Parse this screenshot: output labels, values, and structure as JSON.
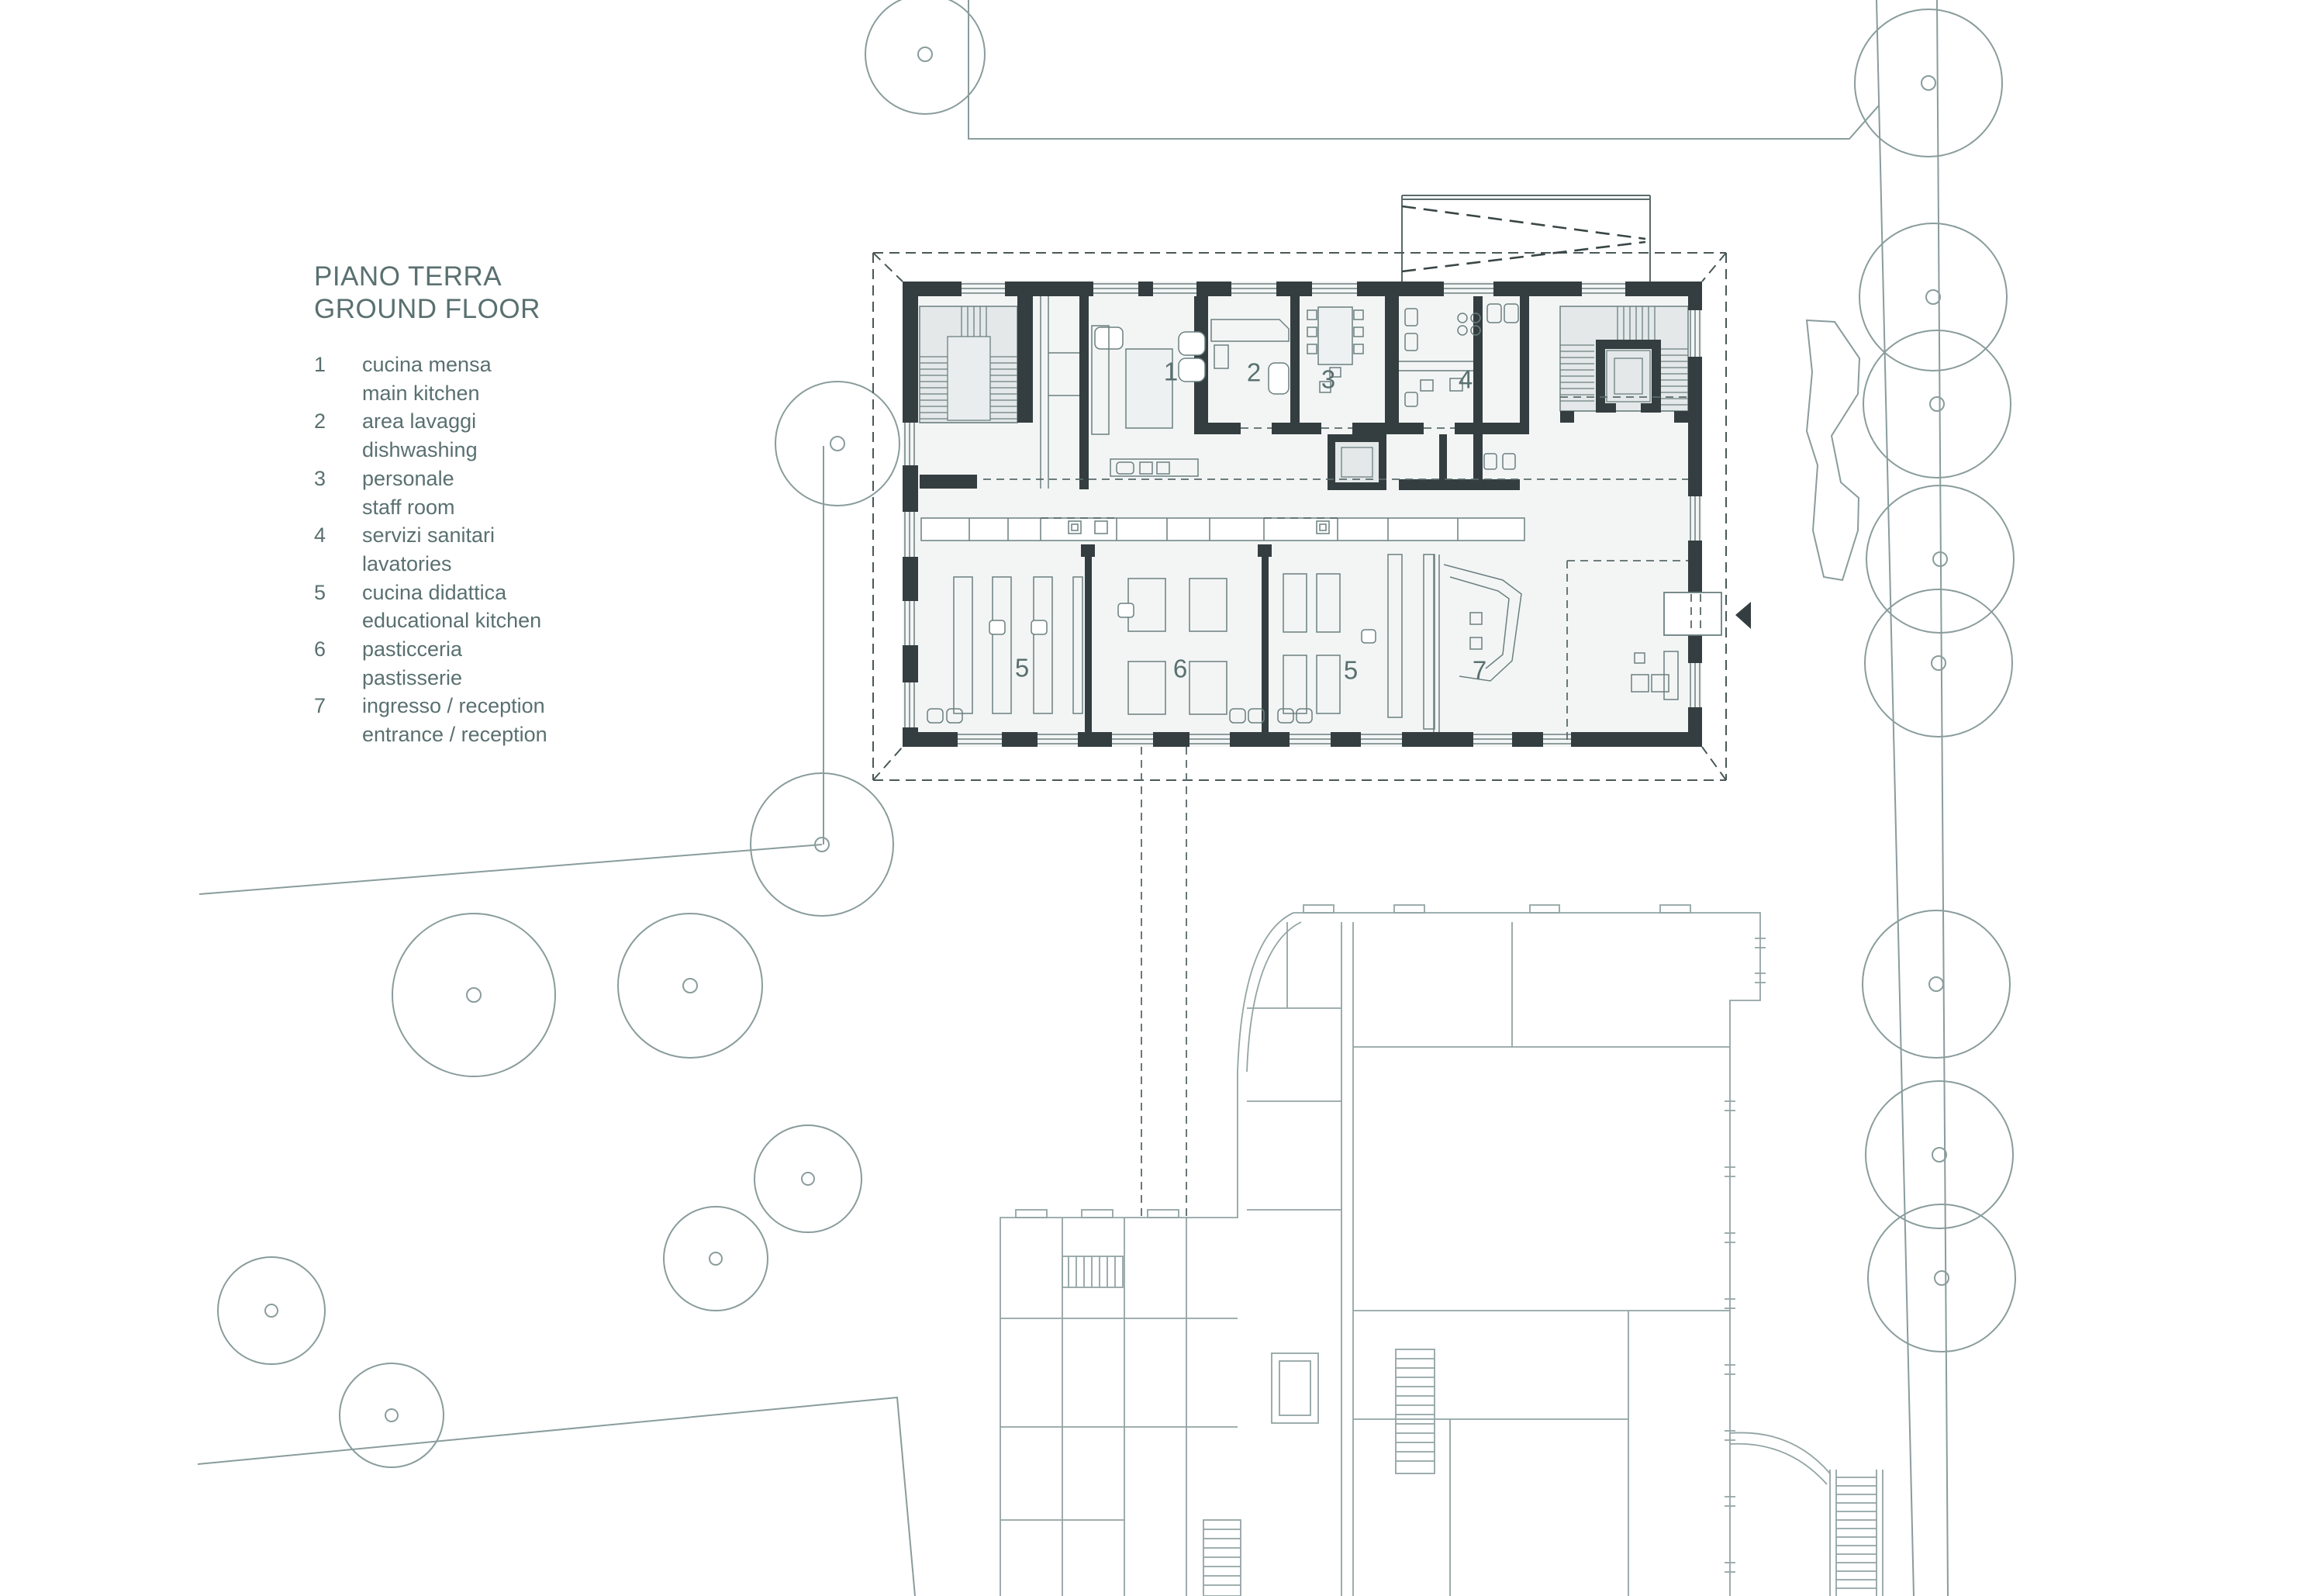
{
  "title": {
    "line1": "PIANO TERRA",
    "line2": "GROUND FLOOR"
  },
  "legend": {
    "items": [
      {
        "num": "1",
        "it": "cucina mensa",
        "en": "main kitchen"
      },
      {
        "num": "2",
        "it": "area lavaggi",
        "en": "dishwashing"
      },
      {
        "num": "3",
        "it": "personale",
        "en": "staff room"
      },
      {
        "num": "4",
        "it": "servizi sanitari",
        "en": "lavatories"
      },
      {
        "num": "5",
        "it": "cucina didattica",
        "en": "educational kitchen"
      },
      {
        "num": "6",
        "it": "pasticceria",
        "en": "pastisserie"
      },
      {
        "num": "7",
        "it": "ingresso / reception",
        "en": "entrance / reception"
      }
    ]
  },
  "plan": {
    "room_labels": [
      {
        "text": "1"
      },
      {
        "text": "2"
      },
      {
        "text": "3"
      },
      {
        "text": "4"
      },
      {
        "text": "5"
      },
      {
        "text": "6"
      },
      {
        "text": "5"
      },
      {
        "text": "7"
      }
    ]
  },
  "icons": {
    "entrance_arrow": "left-pointing-triangle"
  },
  "colors": {
    "wall": "#343e40",
    "text": "#5a7070",
    "stair_fill": "#e4e8e8",
    "floor_fill": "#f3f5f5",
    "furniture_line": "#6c7f7f",
    "old_building_line": "#93a4a4",
    "site_line": "#8a9c9c",
    "dash_line": "#4a5858"
  }
}
